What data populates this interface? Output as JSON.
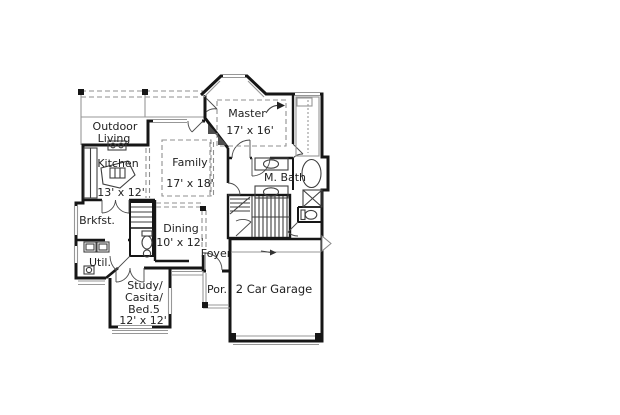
{
  "colors": {
    "wall": "#161616",
    "line_gray": "#979797",
    "dash_gray": "#8f8f8f",
    "text": "#1f1f1f",
    "background": "#ffffff"
  },
  "rooms": {
    "outdoor_living": {
      "line1": "Outdoor",
      "line2": "Living"
    },
    "kitchen": {
      "name": "Kitchen",
      "dims": "13' x 12'"
    },
    "family": {
      "name": "Family",
      "dims": "17' x 18'"
    },
    "master": {
      "name": "Master",
      "dims": "17' x 16'"
    },
    "master_bath": {
      "name": "M. Bath"
    },
    "breakfast": {
      "name": "Brkfst."
    },
    "dining": {
      "name": "Dining",
      "dims": "10' x 12'"
    },
    "foyer": {
      "name": "Foyer"
    },
    "utility": {
      "name": "Util."
    },
    "study": {
      "line1": "Study/",
      "line2": "Casita/",
      "line3": "Bed.5",
      "dims": "12' x 12'"
    },
    "porch": {
      "name": "Por."
    },
    "garage": {
      "name": "2 Car Garage"
    }
  },
  "icons": {
    "ceiling_fan_arrow": "curved arrow",
    "garage_ceiling_arrow": "small arrow",
    "exterior_door_marker": "hollow triangle"
  }
}
